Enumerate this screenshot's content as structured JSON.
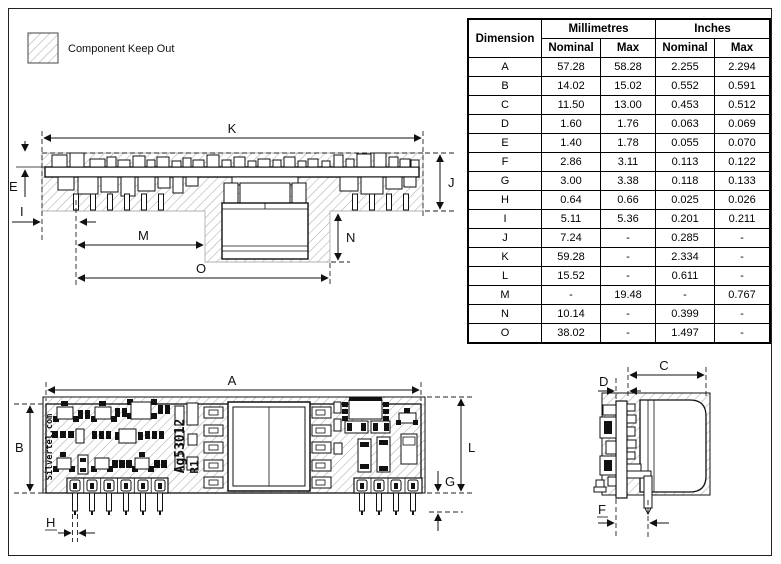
{
  "legend": {
    "label": "Component Keep Out"
  },
  "colors": {
    "line": "#111111",
    "hatch": "#adadad",
    "background": "#ffffff"
  },
  "table": {
    "header": {
      "dimension": "Dimension",
      "groups": [
        "Millimetres",
        "Inches"
      ],
      "sub": [
        "Nominal",
        "Max",
        "Nominal",
        "Max"
      ]
    },
    "rows": [
      {
        "dim": "A",
        "values": [
          "57.28",
          "58.28",
          "2.255",
          "2.294"
        ]
      },
      {
        "dim": "B",
        "values": [
          "14.02",
          "15.02",
          "0.552",
          "0.591"
        ]
      },
      {
        "dim": "C",
        "values": [
          "11.50",
          "13.00",
          "0.453",
          "0.512"
        ]
      },
      {
        "dim": "D",
        "values": [
          "1.60",
          "1.76",
          "0.063",
          "0.069"
        ]
      },
      {
        "dim": "E",
        "values": [
          "1.40",
          "1.78",
          "0.055",
          "0.070"
        ]
      },
      {
        "dim": "F",
        "values": [
          "2.86",
          "3.11",
          "0.113",
          "0.122"
        ]
      },
      {
        "dim": "G",
        "values": [
          "3.00",
          "3.38",
          "0.118",
          "0.133"
        ]
      },
      {
        "dim": "H",
        "values": [
          "0.64",
          "0.66",
          "0.025",
          "0.026"
        ]
      },
      {
        "dim": "I",
        "values": [
          "5.11",
          "5.36",
          "0.201",
          "0.211"
        ]
      },
      {
        "dim": "J",
        "values": [
          "7.24",
          "-",
          "0.285",
          "-"
        ]
      },
      {
        "dim": "K",
        "values": [
          "59.28",
          "-",
          "2.334",
          "-"
        ]
      },
      {
        "dim": "L",
        "values": [
          "15.52",
          "-",
          "0.611",
          "-"
        ]
      },
      {
        "dim": "M",
        "values": [
          "-",
          "19.48",
          "-",
          "0.767"
        ]
      },
      {
        "dim": "N",
        "values": [
          "10.14",
          "-",
          "0.399",
          "-"
        ]
      },
      {
        "dim": "O",
        "values": [
          "38.02",
          "-",
          "1.497",
          "-"
        ]
      }
    ]
  },
  "side_view": {
    "dims": {
      "k": "K",
      "e": "E",
      "j": "J",
      "i": "I",
      "m": "M",
      "n": "N",
      "o": "O"
    }
  },
  "top_view": {
    "dims": {
      "a": "A",
      "b": "B",
      "l": "L",
      "g": "G",
      "h": "H"
    },
    "silkscreen": {
      "brand": "Silvertel.com",
      "part": "Ag53012",
      "rev": "R1"
    }
  },
  "end_view": {
    "dims": {
      "c": "C",
      "d": "D",
      "f": "F"
    }
  }
}
